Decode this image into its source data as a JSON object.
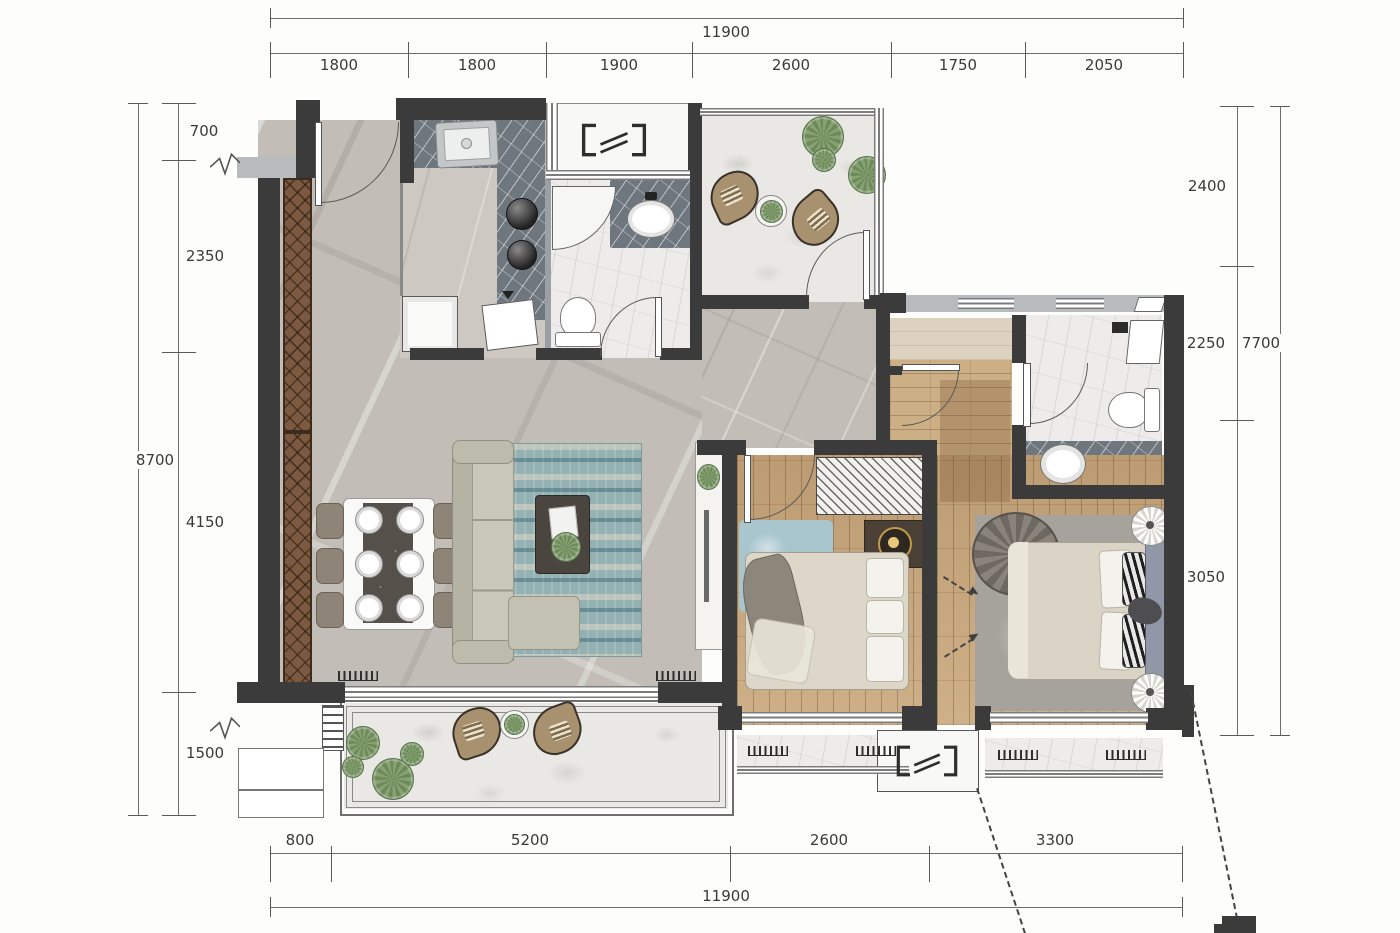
{
  "dims": {
    "top": {
      "overall": "11900",
      "segments": [
        "1800",
        "1800",
        "1900",
        "2600",
        "1750",
        "2050"
      ]
    },
    "bottom": {
      "overall": "11900",
      "segments": [
        "800",
        "5200",
        "2600",
        "3300"
      ]
    },
    "left": {
      "overall": "8700",
      "segments": [
        "700",
        "2350",
        "4150",
        "1500"
      ]
    },
    "right": {
      "overall": "7700",
      "segments": [
        "2400",
        "2250",
        "3050"
      ]
    }
  },
  "colors": {
    "wall": "#3b3b3b",
    "wall_light": "#b7bbbd",
    "wood_floor": "#c6a67c",
    "marble_floor": "#c2beb7",
    "bath_floor": "#edecea",
    "counter_slate": "#6e767e",
    "stone_floor": "#e9e8e4",
    "hall_beige": "#ddd2bf",
    "rug_teal": "#93b0b2",
    "rug_blue": "#a9c6cf",
    "cabinet_brown": "#7c5a41",
    "plant_green": "#7a9466",
    "lamp_gold": "#c09a4d"
  }
}
